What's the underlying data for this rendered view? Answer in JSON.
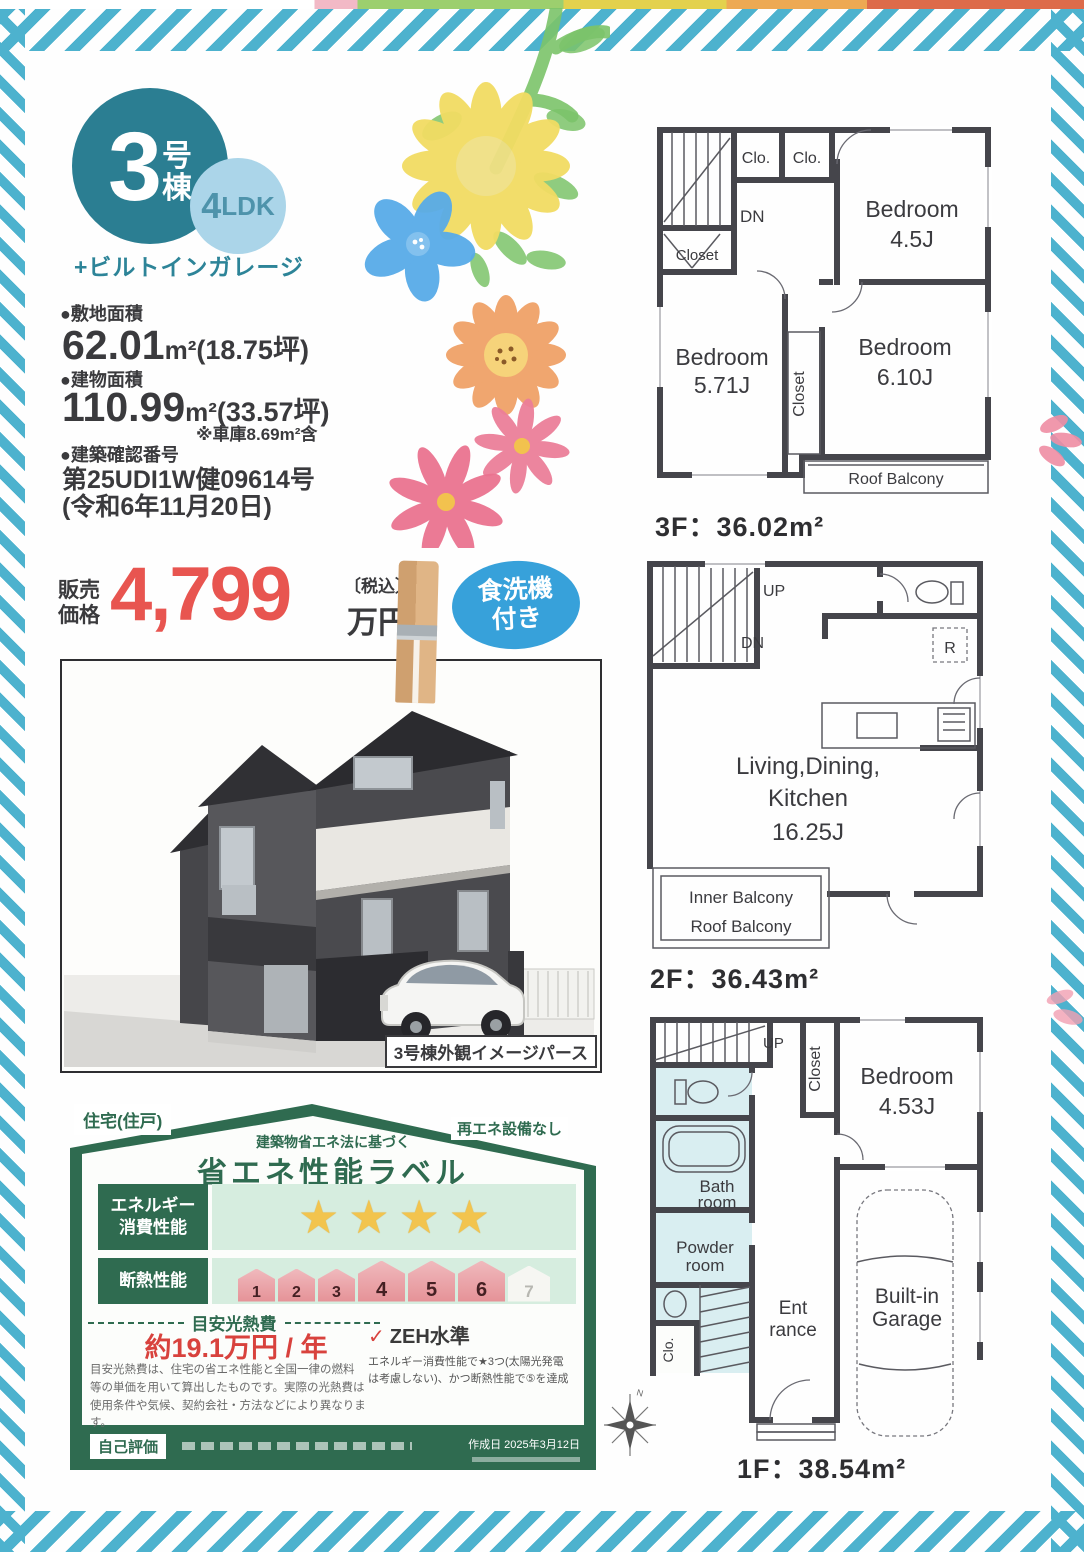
{
  "badge": {
    "number": "3",
    "suffix_1": "号",
    "suffix_2": "棟",
    "layout_num": "4",
    "layout_suffix": "LDK",
    "garage_note": "+ビルトインガレージ"
  },
  "specs": {
    "land_label": "●敷地面積",
    "land_value": "62.01",
    "land_unit": "m²",
    "land_tsubo": "(18.75坪)",
    "building_label": "●建物面積",
    "building_value": "110.99",
    "building_unit": "m²",
    "building_tsubo": "(33.57坪)",
    "building_note": "※車庫8.69m²含",
    "permit_label": "●建築確認番号",
    "permit_number": "第25UDI1W健09614号",
    "permit_date": "(令和6年11月20日)"
  },
  "price": {
    "label_line1": "販売",
    "label_line2": "価格",
    "amount": "4,799",
    "tax_note": "〔税込〕",
    "unit": "万円"
  },
  "feature_badge": {
    "line1": "食洗機",
    "line2": "付き"
  },
  "photo": {
    "caption": "3号棟外観イメージパース"
  },
  "energy_label": {
    "tab_left": "住宅(住戸)",
    "tab_right": "再エネ設備なし",
    "subtitle": "建築物省エネ法に基づく",
    "title": "省エネ性能ラベル",
    "energy_row_line1": "エネルギー",
    "energy_row_line2": "消費性能",
    "stars": "★★★★",
    "insulation_row_label": "断熱性能",
    "insulation_levels": [
      "1",
      "2",
      "3",
      "4",
      "5",
      "6",
      "7"
    ],
    "cost_heading": "目安光熱費",
    "cost_value": "約19.1万円 / 年",
    "zeh_check": "✓",
    "zeh_label": "ZEH水準",
    "zeh_note_line1": "エネルギー消費性能で★3つ(太陽光発電",
    "zeh_note_line2": "は考慮しない)、かつ断熱性能で⑤を達成",
    "disclaimer_line1": "目安光熱費は、住宅の省エネ性能と全国一律の燃料",
    "disclaimer_line2": "等の単価を用いて算出したものです。実際の光熱費は",
    "disclaimer_line3": "使用条件や気候、契約会社・方法などにより異なります。",
    "self_assessment": "自己評価",
    "created_date": "作成日 2025年3月12日"
  },
  "floors": {
    "f3": {
      "caption": "3F：36.02m²",
      "labels": {
        "clo1": "Clo.",
        "clo2": "Clo.",
        "dn": "DN",
        "closet_left": "Closet",
        "bed1_name": "Bedroom",
        "bed1_size": "4.5J",
        "bed2_name": "Bedroom",
        "bed2_size": "5.71J",
        "bed3_name": "Bedroom",
        "bed3_size": "6.10J",
        "closet_mid": "Closet",
        "balcony": "Roof Balcony"
      }
    },
    "f2": {
      "caption": "2F：36.43m²",
      "labels": {
        "up": "UP",
        "dn": "DN",
        "fridge": "R",
        "ldk1": "Living,Dining,",
        "ldk2": "Kitchen",
        "ldk3": "16.25J",
        "inner_balcony": "Inner Balcony",
        "roof_balcony": "Roof Balcony"
      }
    },
    "f1": {
      "caption": "1F：38.54m²",
      "labels": {
        "up": "UP",
        "closet": "Closet",
        "bed_name": "Bedroom",
        "bed_size": "4.53J",
        "bath1": "Bath",
        "bath2": "room",
        "powder1": "Powder",
        "powder2": "room",
        "clo": "Clo.",
        "ent1": "Ent",
        "ent2": "rance",
        "garage1": "Built-in",
        "garage2": "Garage"
      }
    },
    "compass_n": "N"
  }
}
